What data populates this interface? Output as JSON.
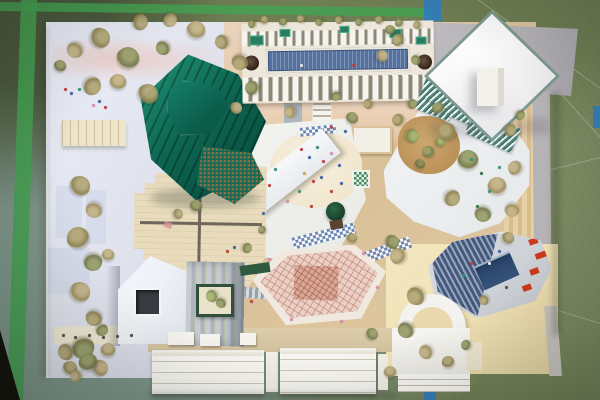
{
  "meta": {
    "description": "Top-down photograph of a physical architectural site model on a green sports-hall linoleum floor with tape line markings",
    "type": "photograph",
    "visible_text": ""
  },
  "colors": {
    "floor_olive": "#6e7d52",
    "floor_olive_dark": "#5a6947",
    "floor_teal": "#7f978d",
    "tape_green": "#46a152",
    "tape_blue": "#2e7dc4",
    "board_lavender": "#e2e4ee",
    "board_gray": "#b6b3b7",
    "ground_tan": "#d9c097",
    "ground_peach": "#e9d0b8",
    "ground_cream": "#f0e2b4",
    "plywood": "#e9dcbd",
    "green_tower": "#0d6753",
    "green_tower_light": "#23977a",
    "green_tower_dark": "#074538",
    "pool_water": "#54719f",
    "pool_deck": "#ece7da",
    "teeth_gap": "#8d8776",
    "pink_hex_base": "#f0e9e0",
    "pink_roof": "#ead0c5",
    "pink_core": "#daa795",
    "house_white": "#eef1f6",
    "window_dark": "#383c40",
    "court_green": "#30503c",
    "oct_deck": "#d0d4d9",
    "oct_blue": "#45597e",
    "oct_blue_light": "#97a6bc",
    "sunken_blue": "#2e4a6e",
    "accent_red": "#cd3a1d",
    "arch_white": "#f3f2ee",
    "plaza_white": "#f1f2ef",
    "slab_white": "#f6f8fa",
    "louver_teal": "#55897e",
    "louver_dark": "#33655c",
    "walk_blue": "#5e7cb0",
    "kiosk_green": "#3f8a5c"
  },
  "tree_palette": {
    "a": [
      "#8c8152",
      "#b3a878"
    ],
    "b": [
      "#9d8e5f",
      "#c4b487"
    ],
    "c": [
      "#75784a",
      "#9aa06b"
    ],
    "d": [
      "#a3906a",
      "#cbbb92"
    ],
    "e": [
      "#6d6b40",
      "#8f8d5c"
    ],
    "m": [
      "#7c8a4e",
      "#a8b574"
    ]
  },
  "figure_palette": {
    "red": "#c9403a",
    "blue": "#3e66b0",
    "teal": "#2f9a7a",
    "pink": "#dc8fae",
    "amber": "#d8a83e",
    "dark": "#55504a",
    "green": "#2f7a45",
    "white": "#f5f5f0"
  },
  "scene": {
    "floor": {
      "label": "green sports-hall linoleum floor with teal worn patch and scratches"
    },
    "tapes": [
      {
        "name": "green-tape-vertical-left",
        "x": 14,
        "y": -4,
        "w": 16,
        "h": 410,
        "rot": 2,
        "color": "tape_green"
      },
      {
        "name": "green-tape-horizontal-top",
        "x": 0,
        "y": 5,
        "w": 432,
        "h": 9,
        "rot": 0.8,
        "color": "tape_green"
      },
      {
        "name": "blue-tape-top",
        "x": 424,
        "y": 0,
        "w": 17,
        "h": 21,
        "rot": 0,
        "color": "tape_blue"
      },
      {
        "name": "blue-tape-right-edge",
        "x": 593,
        "y": 106,
        "w": 7,
        "h": 22,
        "rot": 0,
        "color": "tape_blue"
      },
      {
        "name": "blue-tape-bottom",
        "x": 424,
        "y": 387,
        "w": 12,
        "h": 13,
        "rot": 0,
        "color": "tape_blue"
      }
    ],
    "buildings": [
      {
        "id": "green-faceted-tower",
        "label": "dark emerald faceted tower with hexagonal cap, louvres and lattice base",
        "color": "green_tower"
      },
      {
        "id": "rooftop-pool-building",
        "label": "long slab building with rooftop lap pool, crenellated fin edges, planters and two spiral stair drums",
        "color": "pool_deck"
      },
      {
        "id": "white-diamond-pavilion",
        "label": "white diamond-plan pavilion with small roof cube on gray board",
        "color": "slab_white"
      },
      {
        "id": "terraced-chevron-building",
        "label": "white chevron terrace building with teal louvre glass strips and round tan courtyard",
        "color": "plaza_white"
      },
      {
        "id": "plywood-stepped-building",
        "label": "plywood courtyard block with zigzag stepped corners",
        "color": "plywood"
      },
      {
        "id": "central-plaza-canopy",
        "label": "central plaza with long diagonal white canopy slab, sand area, figures, round tree, checkered crossings",
        "color": "plaza_white"
      },
      {
        "id": "pink-lattice-hexagon-hall",
        "label": "elongated hexagon hall with pink lattice roof",
        "color": "pink_roof"
      },
      {
        "id": "gabled-house-building",
        "label": "white gabled house with dark square window and striped roof wing",
        "color": "house_white"
      },
      {
        "id": "planted-courtyard-box",
        "label": "small dark-green framed courtyard box with moss planting",
        "color": "court_green"
      },
      {
        "id": "blue-louvre-octagon-building",
        "label": "elongated octagon with blue louvre roof, sunken blue court and red accents",
        "color": "oct_blue"
      },
      {
        "id": "arched-vault-building",
        "label": "white semicircular arch vault building with stepped base",
        "color": "arch_white"
      },
      {
        "id": "grandstand-steps",
        "label": "white grandstand step terraces along bottom edge",
        "color": "slab_white"
      },
      {
        "id": "left-terrace-bar",
        "label": "small cream ribbed terrace bar on left board",
        "color": "ground_cream"
      },
      {
        "id": "green-grid-kiosk",
        "label": "tiny green and white gridded kiosk on plaza",
        "color": "kiosk_green"
      }
    ],
    "trees": [
      {
        "x": 80,
        "y": 186,
        "r": 10,
        "c": "a"
      },
      {
        "x": 94,
        "y": 210,
        "r": 8,
        "c": "b"
      },
      {
        "x": 78,
        "y": 238,
        "r": 11,
        "c": "a"
      },
      {
        "x": 93,
        "y": 262,
        "r": 9,
        "c": "c"
      },
      {
        "x": 80,
        "y": 292,
        "r": 10,
        "c": "b"
      },
      {
        "x": 94,
        "y": 318,
        "r": 8,
        "c": "a"
      },
      {
        "x": 83,
        "y": 348,
        "r": 11,
        "c": "c"
      },
      {
        "x": 100,
        "y": 368,
        "r": 8,
        "c": "b"
      },
      {
        "x": 70,
        "y": 368,
        "r": 7,
        "c": "a"
      },
      {
        "x": 108,
        "y": 255,
        "r": 6,
        "c": "b"
      },
      {
        "x": 102,
        "y": 330,
        "r": 6,
        "c": "c"
      },
      {
        "x": 75,
        "y": 50,
        "r": 8,
        "c": "b"
      },
      {
        "x": 100,
        "y": 38,
        "r": 10,
        "c": "a"
      },
      {
        "x": 128,
        "y": 58,
        "r": 11,
        "c": "c"
      },
      {
        "x": 92,
        "y": 86,
        "r": 9,
        "c": "a"
      },
      {
        "x": 118,
        "y": 82,
        "r": 8,
        "c": "b"
      },
      {
        "x": 148,
        "y": 94,
        "r": 10,
        "c": "a"
      },
      {
        "x": 163,
        "y": 48,
        "r": 7,
        "c": "c"
      },
      {
        "x": 196,
        "y": 30,
        "r": 9,
        "c": "b"
      },
      {
        "x": 222,
        "y": 42,
        "r": 7,
        "c": "a"
      },
      {
        "x": 60,
        "y": 66,
        "r": 6,
        "c": "c"
      },
      {
        "x": 140,
        "y": 22,
        "r": 8,
        "c": "a"
      },
      {
        "x": 170,
        "y": 20,
        "r": 7,
        "c": "b"
      },
      {
        "x": 196,
        "y": 206,
        "r": 6,
        "c": "c"
      },
      {
        "x": 178,
        "y": 214,
        "r": 5,
        "c": "a"
      },
      {
        "x": 240,
        "y": 62,
        "r": 8,
        "c": "a"
      },
      {
        "x": 252,
        "y": 88,
        "r": 7,
        "c": "c"
      },
      {
        "x": 236,
        "y": 108,
        "r": 6,
        "c": "b"
      },
      {
        "x": 252,
        "y": 24,
        "r": 4,
        "c": "c"
      },
      {
        "x": 264,
        "y": 20,
        "r": 4,
        "c": "a"
      },
      {
        "x": 283,
        "y": 22,
        "r": 4,
        "c": "c"
      },
      {
        "x": 301,
        "y": 19,
        "r": 4,
        "c": "a"
      },
      {
        "x": 319,
        "y": 22,
        "r": 4,
        "c": "c"
      },
      {
        "x": 339,
        "y": 20,
        "r": 4,
        "c": "a"
      },
      {
        "x": 359,
        "y": 22,
        "r": 4,
        "c": "c"
      },
      {
        "x": 379,
        "y": 20,
        "r": 4,
        "c": "a"
      },
      {
        "x": 399,
        "y": 23,
        "r": 4,
        "c": "c"
      },
      {
        "x": 417,
        "y": 25,
        "r": 4,
        "c": "a"
      },
      {
        "x": 352,
        "y": 118,
        "r": 6,
        "c": "c"
      },
      {
        "x": 368,
        "y": 104,
        "r": 5,
        "c": "a"
      },
      {
        "x": 336,
        "y": 96,
        "r": 5,
        "c": "c"
      },
      {
        "x": 398,
        "y": 120,
        "r": 6,
        "c": "a"
      },
      {
        "x": 412,
        "y": 104,
        "r": 5,
        "c": "c"
      },
      {
        "x": 290,
        "y": 112,
        "r": 6,
        "c": "b"
      },
      {
        "x": 412,
        "y": 136,
        "r": 7,
        "c": "m"
      },
      {
        "x": 428,
        "y": 152,
        "r": 6,
        "c": "c"
      },
      {
        "x": 420,
        "y": 164,
        "r": 5,
        "c": "e"
      },
      {
        "x": 440,
        "y": 142,
        "r": 5,
        "c": "m"
      },
      {
        "x": 447,
        "y": 132,
        "r": 9,
        "c": "a"
      },
      {
        "x": 468,
        "y": 160,
        "r": 10,
        "c": "c"
      },
      {
        "x": 497,
        "y": 186,
        "r": 9,
        "c": "b"
      },
      {
        "x": 452,
        "y": 198,
        "r": 8,
        "c": "a"
      },
      {
        "x": 483,
        "y": 214,
        "r": 8,
        "c": "c"
      },
      {
        "x": 515,
        "y": 168,
        "r": 7,
        "c": "b"
      },
      {
        "x": 510,
        "y": 130,
        "r": 6,
        "c": "a"
      },
      {
        "x": 438,
        "y": 108,
        "r": 6,
        "c": "c"
      },
      {
        "x": 512,
        "y": 210,
        "r": 7,
        "c": "b"
      },
      {
        "x": 508,
        "y": 238,
        "r": 6,
        "c": "a"
      },
      {
        "x": 520,
        "y": 115,
        "r": 5,
        "c": "c"
      },
      {
        "x": 398,
        "y": 40,
        "r": 6,
        "c": "a"
      },
      {
        "x": 416,
        "y": 60,
        "r": 5,
        "c": "c"
      },
      {
        "x": 382,
        "y": 56,
        "r": 6,
        "c": "b"
      },
      {
        "x": 390,
        "y": 30,
        "r": 5,
        "c": "c"
      },
      {
        "x": 398,
        "y": 256,
        "r": 8,
        "c": "b"
      },
      {
        "x": 416,
        "y": 296,
        "r": 9,
        "c": "a"
      },
      {
        "x": 406,
        "y": 330,
        "r": 8,
        "c": "c"
      },
      {
        "x": 426,
        "y": 352,
        "r": 7,
        "c": "b"
      },
      {
        "x": 448,
        "y": 362,
        "r": 6,
        "c": "a"
      },
      {
        "x": 372,
        "y": 334,
        "r": 6,
        "c": "c"
      },
      {
        "x": 390,
        "y": 372,
        "r": 6,
        "c": "b"
      },
      {
        "x": 466,
        "y": 345,
        "r": 5,
        "c": "c"
      },
      {
        "x": 484,
        "y": 300,
        "r": 5,
        "c": "a"
      },
      {
        "x": 66,
        "y": 352,
        "r": 8,
        "c": "a"
      },
      {
        "x": 88,
        "y": 362,
        "r": 9,
        "c": "c"
      },
      {
        "x": 108,
        "y": 350,
        "r": 7,
        "c": "b"
      },
      {
        "x": 76,
        "y": 376,
        "r": 6,
        "c": "b"
      },
      {
        "x": 212,
        "y": 296,
        "r": 6,
        "c": "m"
      },
      {
        "x": 221,
        "y": 303,
        "r": 5,
        "c": "c"
      },
      {
        "x": 247,
        "y": 248,
        "r": 5,
        "c": "c"
      },
      {
        "x": 352,
        "y": 238,
        "r": 5,
        "c": "a"
      },
      {
        "x": 392,
        "y": 242,
        "r": 7,
        "c": "c"
      },
      {
        "x": 262,
        "y": 230,
        "r": 4,
        "c": "c"
      }
    ],
    "figures": [
      {
        "x": 300,
        "y": 148,
        "c": "red"
      },
      {
        "x": 308,
        "y": 156,
        "c": "blue"
      },
      {
        "x": 316,
        "y": 146,
        "c": "teal"
      },
      {
        "x": 322,
        "y": 160,
        "c": "red"
      },
      {
        "x": 330,
        "y": 152,
        "c": "pink"
      },
      {
        "x": 338,
        "y": 164,
        "c": "blue"
      },
      {
        "x": 303,
        "y": 172,
        "c": "amber"
      },
      {
        "x": 312,
        "y": 180,
        "c": "red"
      },
      {
        "x": 320,
        "y": 176,
        "c": "blue"
      },
      {
        "x": 298,
        "y": 190,
        "c": "teal"
      },
      {
        "x": 330,
        "y": 190,
        "c": "red"
      },
      {
        "x": 340,
        "y": 182,
        "c": "blue"
      },
      {
        "x": 286,
        "y": 200,
        "c": "pink"
      },
      {
        "x": 310,
        "y": 205,
        "c": "red"
      },
      {
        "x": 262,
        "y": 212,
        "c": "blue"
      },
      {
        "x": 274,
        "y": 168,
        "c": "teal"
      },
      {
        "x": 268,
        "y": 184,
        "c": "red"
      },
      {
        "x": 470,
        "y": 158,
        "c": "teal"
      },
      {
        "x": 480,
        "y": 172,
        "c": "green"
      },
      {
        "x": 488,
        "y": 190,
        "c": "teal"
      },
      {
        "x": 476,
        "y": 205,
        "c": "green"
      },
      {
        "x": 498,
        "y": 166,
        "c": "teal"
      },
      {
        "x": 352,
        "y": 64,
        "c": "red"
      },
      {
        "x": 300,
        "y": 64,
        "c": "white"
      },
      {
        "x": 330,
        "y": 126,
        "c": "red"
      },
      {
        "x": 344,
        "y": 130,
        "c": "blue"
      },
      {
        "x": 470,
        "y": 262,
        "c": "red"
      },
      {
        "x": 462,
        "y": 274,
        "c": "teal"
      },
      {
        "x": 498,
        "y": 250,
        "c": "blue"
      },
      {
        "x": 505,
        "y": 286,
        "c": "dark"
      },
      {
        "x": 488,
        "y": 262,
        "c": "white"
      },
      {
        "x": 62,
        "y": 334,
        "c": "dark"
      },
      {
        "x": 74,
        "y": 336,
        "c": "dark"
      },
      {
        "x": 88,
        "y": 334,
        "c": "dark"
      },
      {
        "x": 102,
        "y": 336,
        "c": "dark"
      },
      {
        "x": 116,
        "y": 335,
        "c": "dark"
      },
      {
        "x": 130,
        "y": 334,
        "c": "dark"
      },
      {
        "x": 64,
        "y": 88,
        "c": "red"
      },
      {
        "x": 70,
        "y": 92,
        "c": "blue"
      },
      {
        "x": 78,
        "y": 88,
        "c": "teal"
      },
      {
        "x": 92,
        "y": 104,
        "c": "pink"
      },
      {
        "x": 98,
        "y": 100,
        "c": "blue"
      },
      {
        "x": 104,
        "y": 106,
        "c": "red"
      },
      {
        "x": 226,
        "y": 250,
        "c": "red"
      },
      {
        "x": 233,
        "y": 246,
        "c": "blue"
      },
      {
        "x": 268,
        "y": 258,
        "c": "pink"
      },
      {
        "x": 362,
        "y": 252,
        "c": "pink"
      },
      {
        "x": 376,
        "y": 286,
        "c": "pink"
      },
      {
        "x": 290,
        "y": 318,
        "c": "pink"
      },
      {
        "x": 340,
        "y": 320,
        "c": "pink"
      },
      {
        "x": 250,
        "y": 300,
        "c": "red"
      }
    ]
  }
}
